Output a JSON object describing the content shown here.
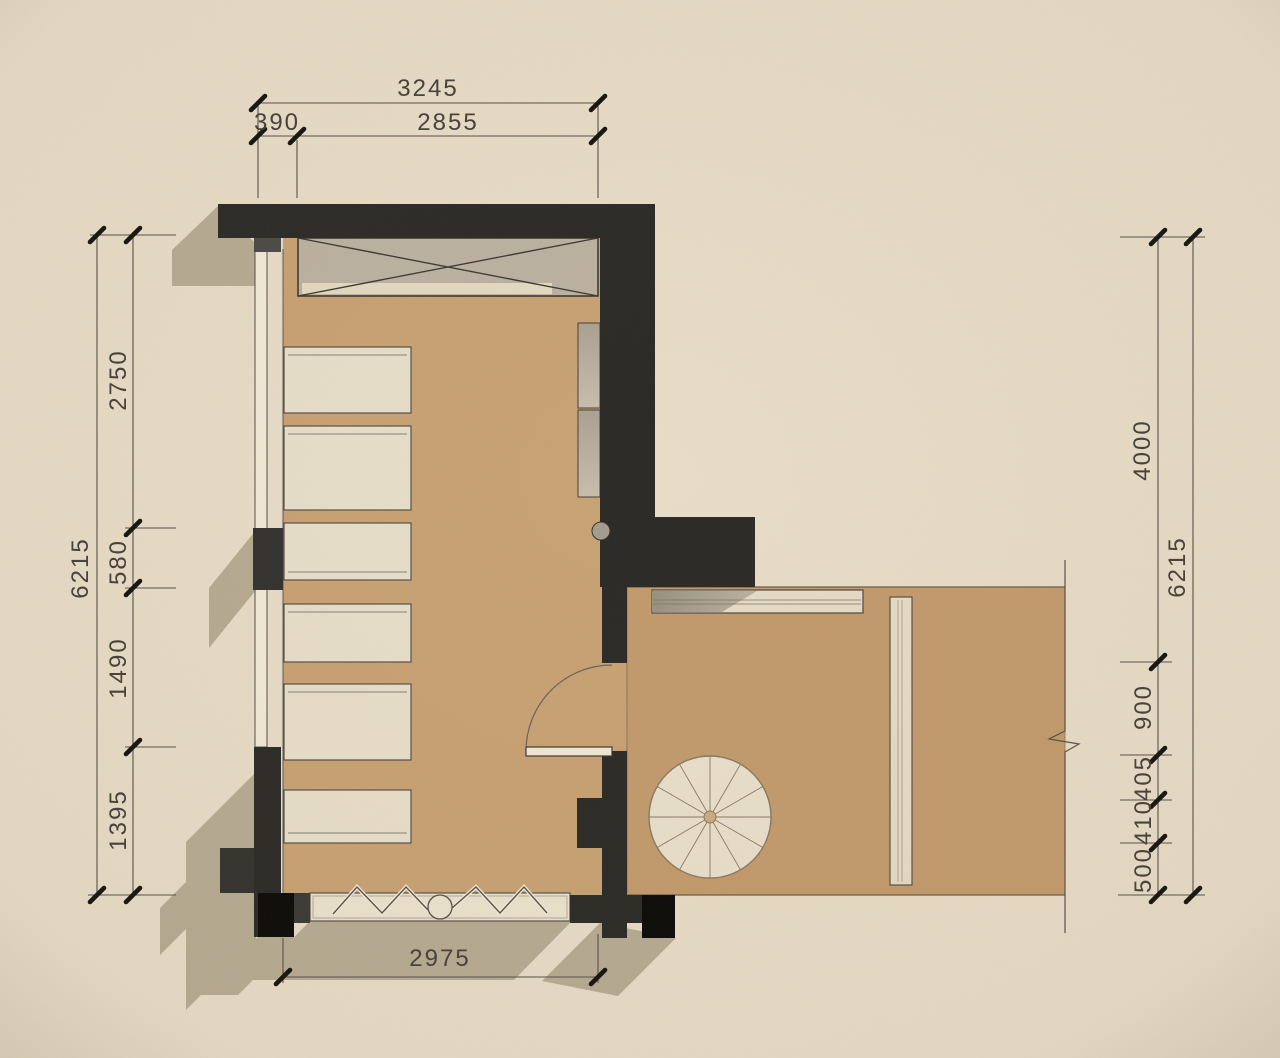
{
  "drawing": {
    "type": "architectural-floor-plan",
    "dims": {
      "top": {
        "total": "3245",
        "seg_a": "390",
        "seg_b": "2855"
      },
      "left": {
        "total": "6215",
        "segments": [
          "2750",
          "580",
          "1490",
          "1395"
        ]
      },
      "right": {
        "total": "6215",
        "upper": "4000",
        "segments": [
          "900",
          "405",
          "410",
          "500"
        ]
      },
      "bottom": {
        "total": "2975"
      }
    },
    "colors": {
      "paper": "#e8ddc8",
      "wall": "#2b2a27",
      "wall_black": "#0b0a09",
      "floor_hall": "#c8a274",
      "floor_room": "#c29b6d",
      "furniture_fill": "#e8dfcb",
      "wardrobe_fill": "#bcb2a2",
      "shadow": "#b3a78e",
      "line": "#57504a",
      "text": "#45403a"
    }
  }
}
